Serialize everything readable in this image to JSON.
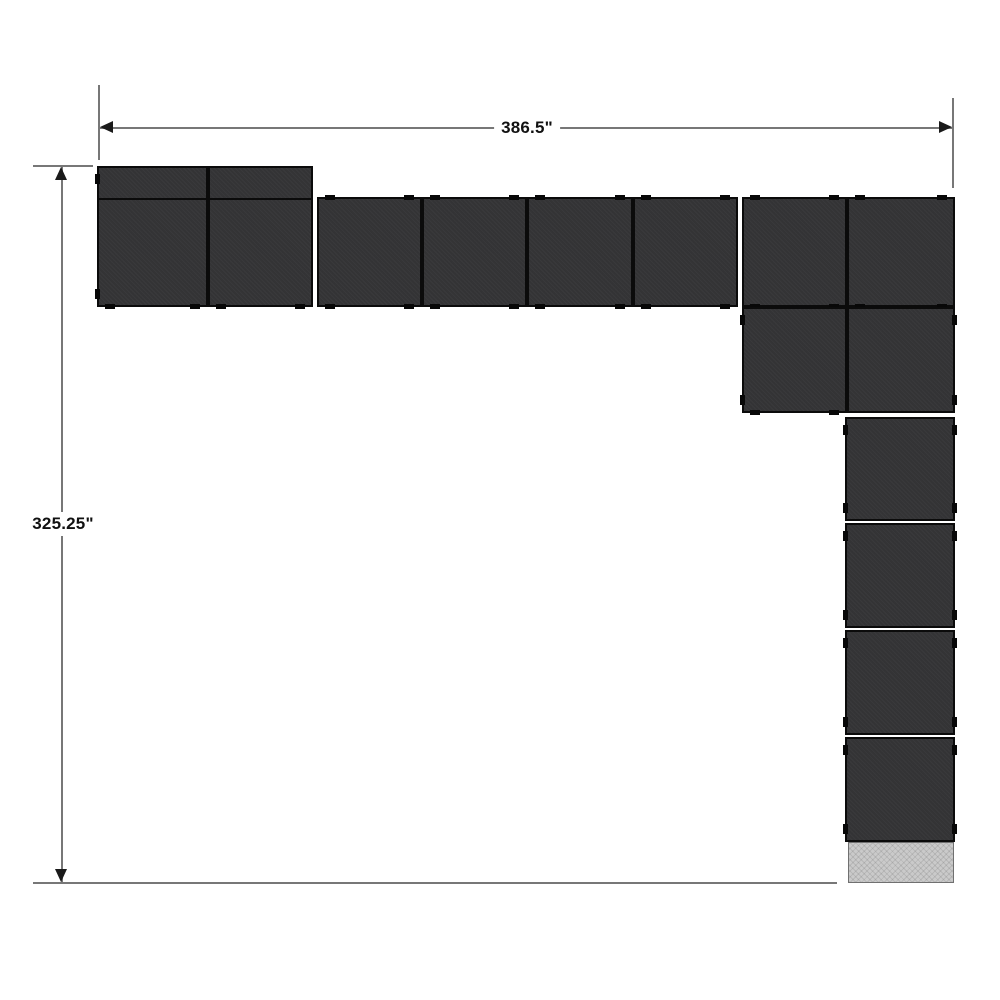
{
  "diagram": {
    "type": "modular-panel-layout-plan",
    "dimensions": {
      "width_label": "386.5\"",
      "height_label": "325.25\""
    },
    "colors": {
      "background": "#ffffff",
      "module_fill": "#353537",
      "module_border": "#0b0b0b",
      "tab": "#080808",
      "dimension_line": "#777777",
      "arrow": "#1a1a1a",
      "label_text": "#111111",
      "end_panel_fill": "#cacaca",
      "end_panel_border": "#707070"
    },
    "canvas": {
      "width": 1000,
      "height": 1000
    },
    "modules": [
      {
        "id": "deep-left-1",
        "type": "deep",
        "x": 97,
        "y": 166,
        "w": 111,
        "h": 141,
        "band_offset": 30,
        "tabs": [
          "left",
          "bottom"
        ]
      },
      {
        "id": "deep-left-2",
        "type": "deep",
        "x": 208,
        "y": 166,
        "w": 105,
        "h": 141,
        "band_offset": 30,
        "tabs": [
          "bottom"
        ]
      },
      {
        "id": "row-1",
        "type": "row",
        "x": 317,
        "y": 197,
        "w": 105,
        "h": 110,
        "tabs": [
          "top",
          "bottom"
        ]
      },
      {
        "id": "row-2",
        "type": "row",
        "x": 422,
        "y": 197,
        "w": 105,
        "h": 110,
        "tabs": [
          "top",
          "bottom"
        ]
      },
      {
        "id": "row-3",
        "type": "row",
        "x": 527,
        "y": 197,
        "w": 106,
        "h": 110,
        "tabs": [
          "top",
          "bottom"
        ]
      },
      {
        "id": "row-4",
        "type": "row",
        "x": 633,
        "y": 197,
        "w": 105,
        "h": 110,
        "tabs": [
          "top",
          "bottom"
        ]
      },
      {
        "id": "row-5",
        "type": "row",
        "x": 742,
        "y": 197,
        "w": 105,
        "h": 110,
        "tabs": [
          "top",
          "bottom"
        ]
      },
      {
        "id": "row-6",
        "type": "row",
        "x": 847,
        "y": 197,
        "w": 108,
        "h": 110,
        "tabs": [
          "top",
          "bottom"
        ]
      },
      {
        "id": "corner-1",
        "type": "corner",
        "x": 742,
        "y": 307,
        "w": 105,
        "h": 106,
        "tabs": [
          "left",
          "bottom"
        ]
      },
      {
        "id": "corner-2",
        "type": "corner",
        "x": 847,
        "y": 307,
        "w": 108,
        "h": 106,
        "tabs": [
          "right"
        ]
      },
      {
        "id": "column-1",
        "type": "column",
        "x": 845,
        "y": 417,
        "w": 110,
        "h": 104,
        "tabs": [
          "left",
          "right"
        ]
      },
      {
        "id": "column-2",
        "type": "column",
        "x": 845,
        "y": 523,
        "w": 110,
        "h": 105,
        "tabs": [
          "left",
          "right"
        ]
      },
      {
        "id": "column-3",
        "type": "column",
        "x": 845,
        "y": 630,
        "w": 110,
        "h": 105,
        "tabs": [
          "left",
          "right"
        ]
      },
      {
        "id": "column-4",
        "type": "column",
        "x": 845,
        "y": 737,
        "w": 110,
        "h": 105,
        "tabs": [
          "left",
          "right"
        ]
      }
    ],
    "end_panel": {
      "x": 848,
      "y": 842,
      "w": 106,
      "h": 41
    },
    "dimension_lines": {
      "top": {
        "y": 128,
        "x1": 100,
        "x2": 952,
        "label_x": 527,
        "ext_left": {
          "x": 99,
          "y1": 85,
          "y2": 160
        },
        "ext_right": {
          "x": 953,
          "y1": 98,
          "y2": 188
        }
      },
      "left": {
        "x": 62,
        "y1": 167,
        "y2": 882,
        "label_y": 524,
        "ext_top": {
          "y": 166,
          "x1": 33,
          "x2": 93
        },
        "ext_bottom": {
          "y": 883,
          "x1": 33,
          "x2": 837
        }
      }
    }
  }
}
